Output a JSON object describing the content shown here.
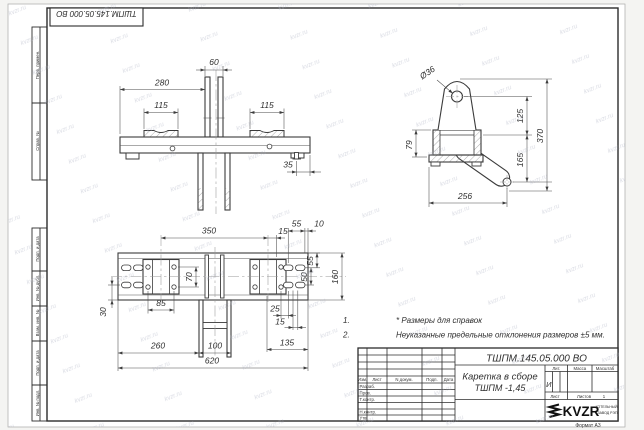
{
  "sheet": {
    "format": "Формат А3"
  },
  "watermark": {
    "text": "kvzr.ru"
  },
  "corner_stamp": {
    "designation": "ТШПМ.145.05.000  ВО"
  },
  "margin_labels": {
    "perv_primen": "Перв. примен.",
    "sprav_no": "Справ. №",
    "podp_data_1": "Подп. и дата",
    "inv_dubl": "Инв. № дубл.",
    "vzam_inv": "Взам. инв. №",
    "podp_data_2": "Подп. и дата",
    "inv_podl": "Инв. № подл."
  },
  "front_view": {
    "dims": {
      "width_280": "280",
      "gap_60": "60",
      "pad_left_115": "115",
      "pad_right_115": "115",
      "offset_35": "35"
    }
  },
  "side_view": {
    "dims": {
      "hole_dia": "Ø36",
      "base_79": "79",
      "upper_125": "125",
      "lower_165": "165",
      "total_370": "370",
      "reach_256": "256"
    }
  },
  "plan_view": {
    "dims": {
      "span_350": "350",
      "off_15": "15",
      "top_55": "55",
      "top_10": "10",
      "right_55": "55",
      "right_50": "50",
      "height_160": "160",
      "holes_70": "70",
      "holes_85": "85",
      "off_25": "25",
      "off_15b": "15",
      "left_30": "30",
      "bottom_260": "260",
      "bottom_100": "100",
      "bottom_135": "135",
      "total_620": "620"
    }
  },
  "notes": {
    "n1_no": "1.",
    "n1": "* Размеры для справок",
    "n2_no": "2.",
    "n2": "Неуказанные предельные отклонения размеров  ±5 мм."
  },
  "title_block": {
    "designation": "ТШПМ.145.05.000  ВО",
    "name_line1": "Каретка в сборе",
    "name_line2": "ТШПМ -1,45",
    "cols": {
      "izm": "Изм.",
      "list": "Лист",
      "doc": "N докум.",
      "podp": "Подп.",
      "data": "Дата"
    },
    "rows": {
      "razrab": "Разраб.",
      "prov": "Пров.",
      "tkontr": "Т.контр.",
      "nkontr": "Н.контр.",
      "utv": "Утв."
    },
    "lit_label": "Лит.",
    "massa_label": "Масса",
    "scale_label": "Масштаб",
    "lit_value": "И",
    "sheet_label": "Лист",
    "sheets_label": "Листов",
    "sheets_value": "1"
  },
  "logo": {
    "brand": "KVZR",
    "org_line1": "КОТЕЛЬНЫЙ",
    "org_line2": "ЗАВОД РЭП"
  }
}
